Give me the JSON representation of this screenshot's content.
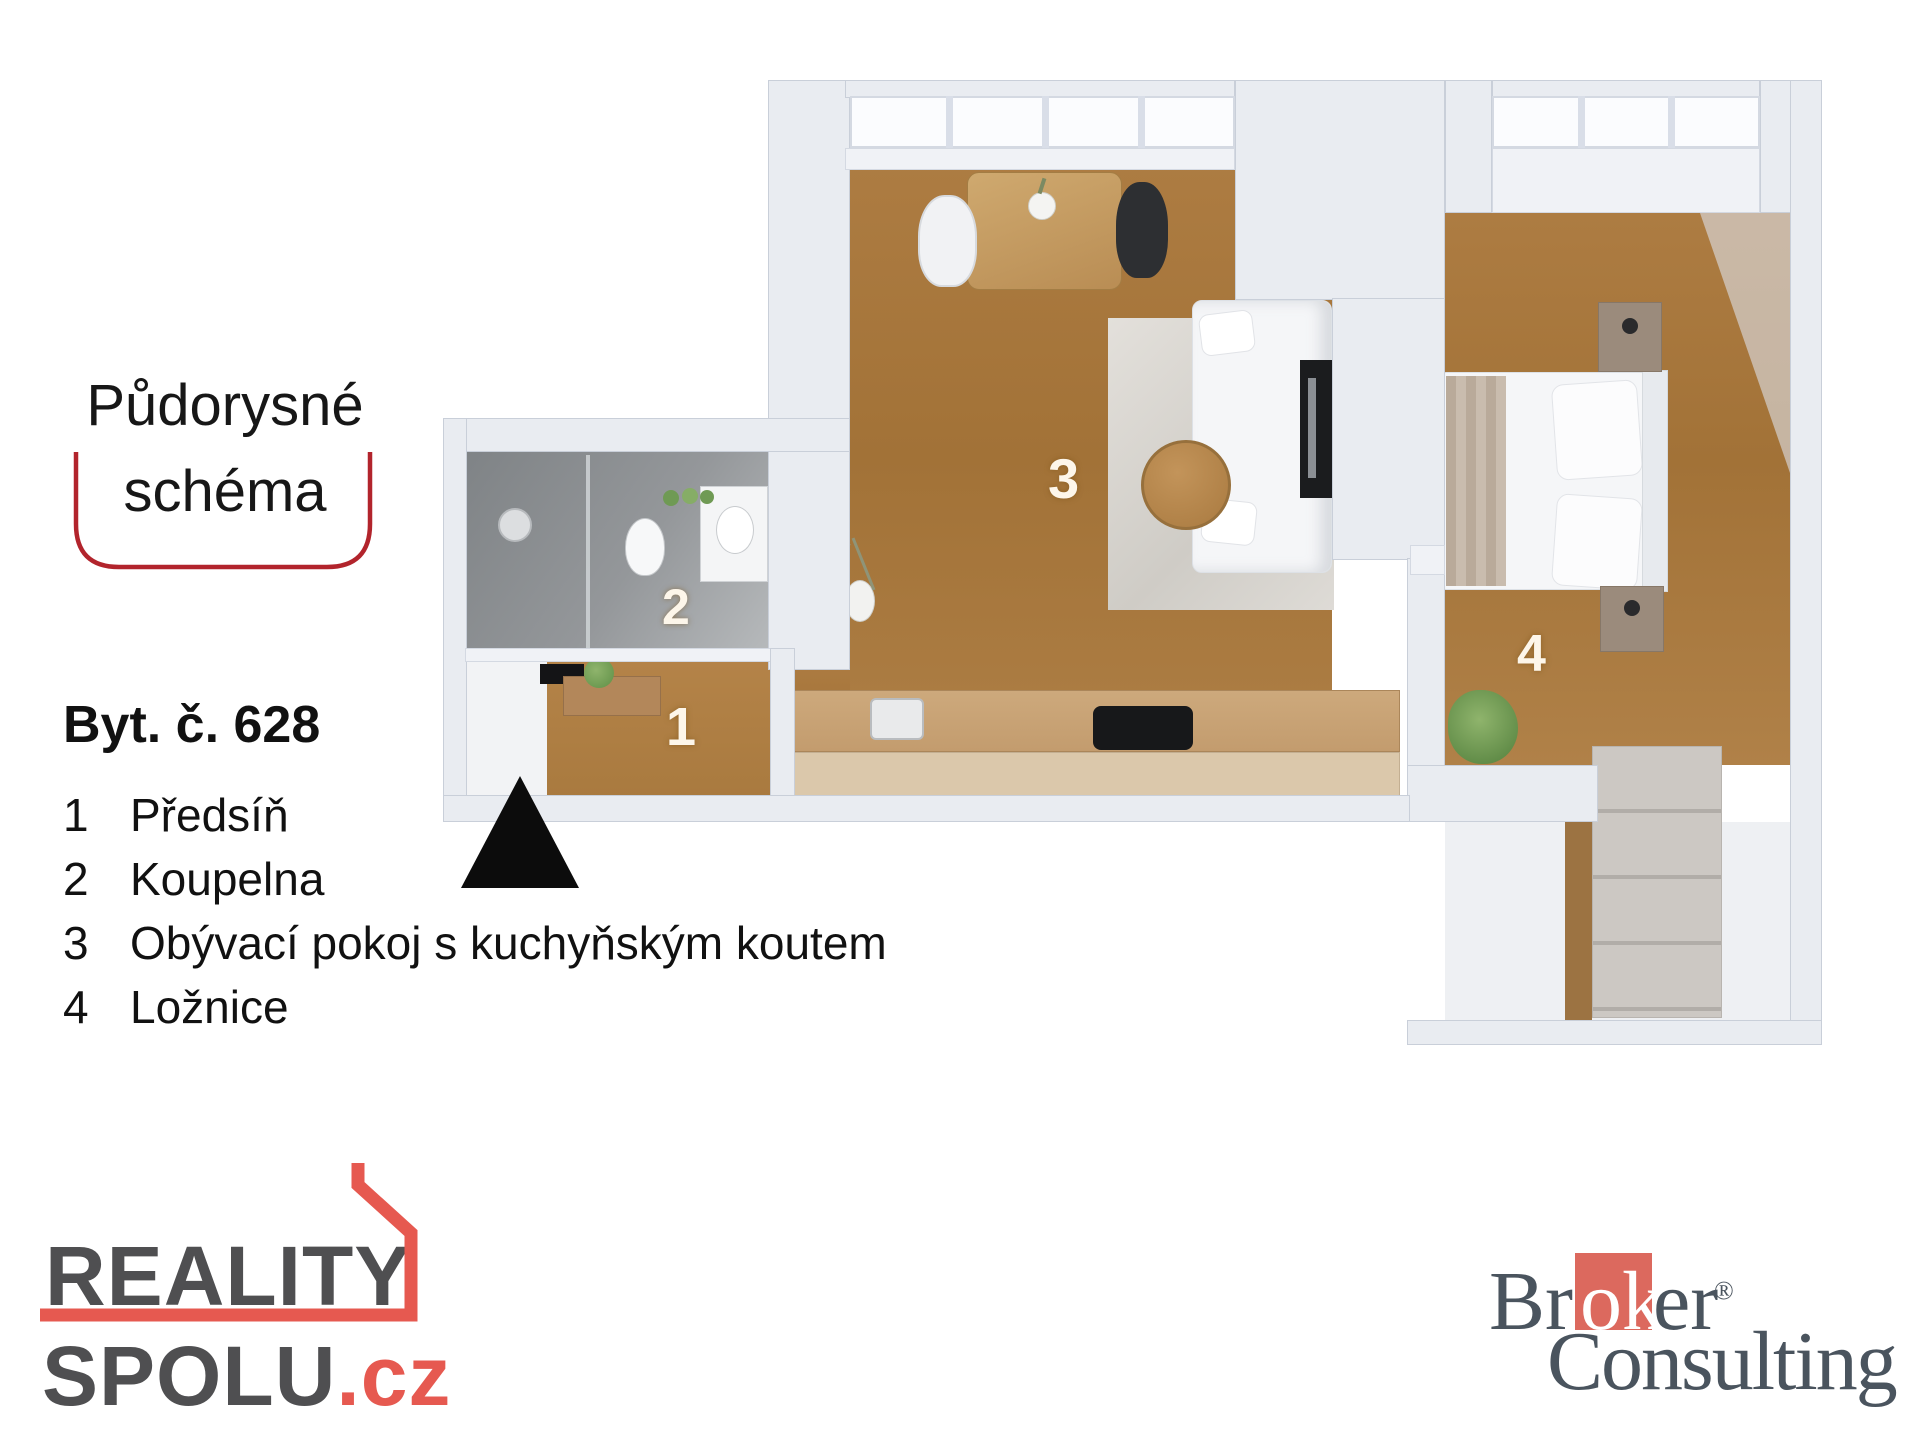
{
  "title": {
    "line1": "Půdorysné",
    "line2": "schéma"
  },
  "apartment_label": "Byt. č. 628",
  "legend": [
    {
      "num": "1",
      "label": "Předsíň"
    },
    {
      "num": "2",
      "label": "Koupelna"
    },
    {
      "num": "3",
      "label": "Obývací pokoj s kuchyňským koutem"
    },
    {
      "num": "4",
      "label": "Ložnice"
    }
  ],
  "plan": {
    "room_numbers": {
      "hall": "1",
      "bathroom": "2",
      "living": "3",
      "bedroom": "4"
    }
  },
  "logos": {
    "reality_spolu": {
      "word1": "REALITY",
      "word2": "SPOLU",
      "tld": ".cz"
    },
    "broker_consulting": {
      "part1": "Br",
      "part2": "ok",
      "part3": "er",
      "reg": "®",
      "line2": "Consulting"
    }
  },
  "colors": {
    "bracket_red": "#b2242c",
    "reality_red": "#e65950",
    "reality_gray": "#4f4f51",
    "broker_red": "#dc695e",
    "broker_gray": "#4a545e",
    "wood_floor": "#a87840",
    "wall_gray": "#e9ecf1",
    "bathroom_gray": "#94979a",
    "entrance_black": "#0c0c0c"
  }
}
